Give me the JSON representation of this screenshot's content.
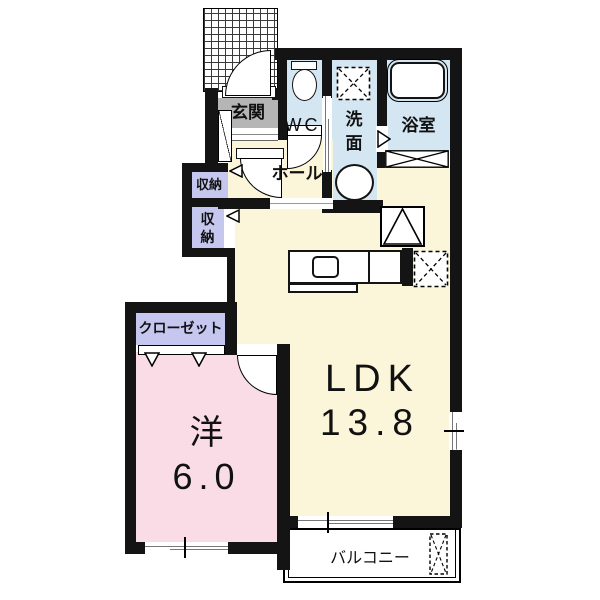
{
  "plan_title": "apartment-floor-plan",
  "colors": {
    "cream": "#FBF6D9",
    "pink": "#FADCE6",
    "blue": "#D3E6F2",
    "purple": "#C6C7EF",
    "gray": "#B5B5B5",
    "wall": "#141414"
  },
  "rooms": {
    "genkan": {
      "label": "玄関"
    },
    "wc": {
      "label": "WC"
    },
    "washroom": {
      "label": "洗面"
    },
    "bathroom": {
      "label": "浴室"
    },
    "hall": {
      "label": "ホール"
    },
    "storage_upper": {
      "label": "収納"
    },
    "storage_lower": {
      "label": "収納"
    },
    "closet": {
      "label": "クローゼット"
    },
    "ldk": {
      "label": "LDK",
      "size": "13.8"
    },
    "western_room": {
      "label": "洋",
      "size": "6.0"
    },
    "balcony": {
      "label": "バルコニー"
    }
  }
}
